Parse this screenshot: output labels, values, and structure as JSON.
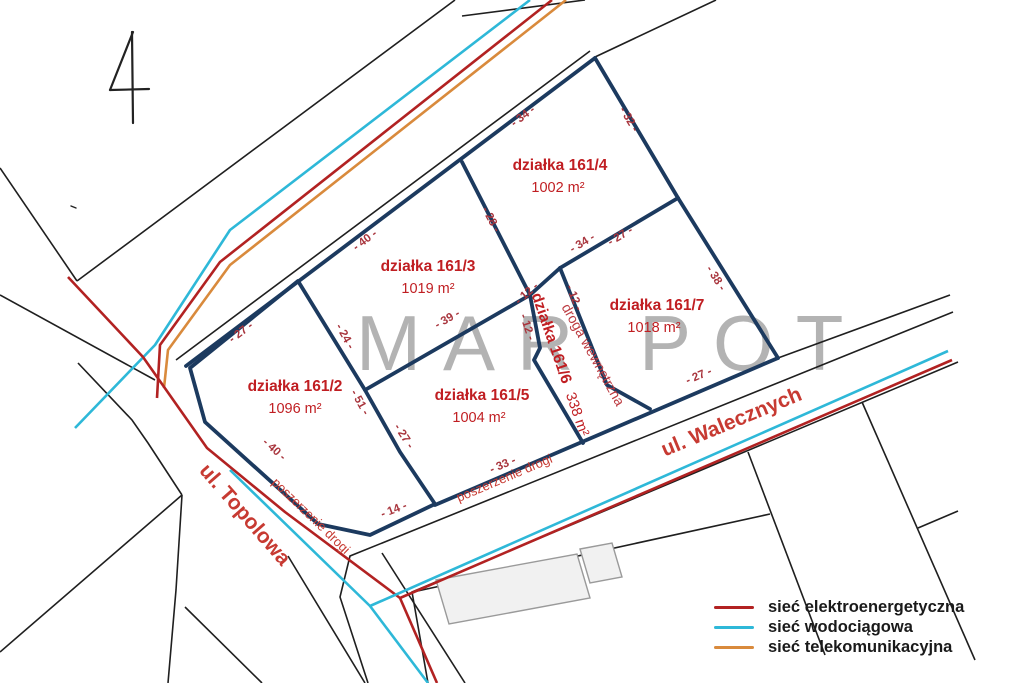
{
  "sheet": {
    "number": "4"
  },
  "watermark": {
    "text": "MAR POT"
  },
  "plots": {
    "p161_2": {
      "name": "działka 161/2",
      "area": "1096 m²"
    },
    "p161_3": {
      "name": "działka 161/3",
      "area": "1019 m²"
    },
    "p161_4": {
      "name": "działka 161/4",
      "area": "1002 m²"
    },
    "p161_5": {
      "name": "działka 161/5",
      "area": "1004 m²"
    },
    "p161_6": {
      "name": "działka 161/6",
      "area": "338 m²"
    },
    "p161_7": {
      "name": "działka 161/7",
      "area": "1018 m²"
    }
  },
  "labels": {
    "street_topolowa": "ul. Topolowa",
    "street_walecznych": "ul. Walecznych",
    "internal_road": "droga wewnętrzna",
    "road_widening_1": "poszerzenie drogi",
    "road_widening_2": "poszerzenie drogi"
  },
  "dimensions": [
    {
      "text": "- 34 -"
    },
    {
      "text": "- 32 -"
    },
    {
      "text": "- 40 -"
    },
    {
      "text": "- 28 -"
    },
    {
      "text": "- 34 -"
    },
    {
      "text": "- 27 -"
    },
    {
      "text": "- 38 -"
    },
    {
      "text": "- 27 -"
    },
    {
      "text": "- 24 -"
    },
    {
      "text": "- 39 -"
    },
    {
      "text": "- 12 -"
    },
    {
      "text": "- 12 -"
    },
    {
      "text": "- 12 -"
    },
    {
      "text": "- 51 -"
    },
    {
      "text": "- 27 -"
    },
    {
      "text": "- 14 -"
    },
    {
      "text": "- 40 -"
    },
    {
      "text": "- 33 -"
    },
    {
      "text": "- 27 -"
    }
  ],
  "legend": {
    "items": [
      {
        "label": "sieć elektroenergetyczna",
        "color": "#b22222"
      },
      {
        "label": "sieć wodociągowa",
        "color": "#2eb8d8"
      },
      {
        "label": "sieć telekomunikacyjna",
        "color": "#d98a3c"
      }
    ]
  },
  "colors": {
    "plot_boundary": "#1c3a5f",
    "highlight_fill": "#f9d2d6",
    "label_red": "#c01e22",
    "power": "#b22222",
    "water": "#2eb8d8",
    "telecom": "#d98a3c"
  }
}
